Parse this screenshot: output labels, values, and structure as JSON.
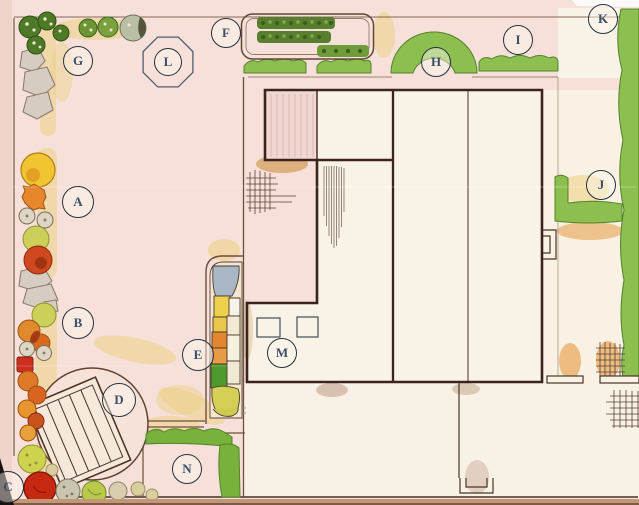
{
  "plan": {
    "title": "hand-drawn garden landscape plan",
    "labels": [
      {
        "letter": "A"
      },
      {
        "letter": "B"
      },
      {
        "letter": "C"
      },
      {
        "letter": "D"
      },
      {
        "letter": "E"
      },
      {
        "letter": "F"
      },
      {
        "letter": "G"
      },
      {
        "letter": "H"
      },
      {
        "letter": "I"
      },
      {
        "letter": "J"
      },
      {
        "letter": "K"
      },
      {
        "letter": "L"
      },
      {
        "letter": "M"
      },
      {
        "letter": "N"
      }
    ],
    "palette": {
      "paper_pink": "#f6e0d9",
      "building_cream": "#f9f2e6",
      "hedge_green": "#8cbf4f",
      "dark_bush_green": "#4e7a28",
      "sand_yellow": "#eccf7e",
      "accent_orange": "#e8862c",
      "accent_red": "#cc2f1f",
      "accent_yellow": "#f1c431",
      "stone_gray": "#d7ccc1",
      "mosaic_blue": "#a9b6c6",
      "ink_brown": "#3a241c",
      "label_ink": "#3b4f66"
    }
  }
}
